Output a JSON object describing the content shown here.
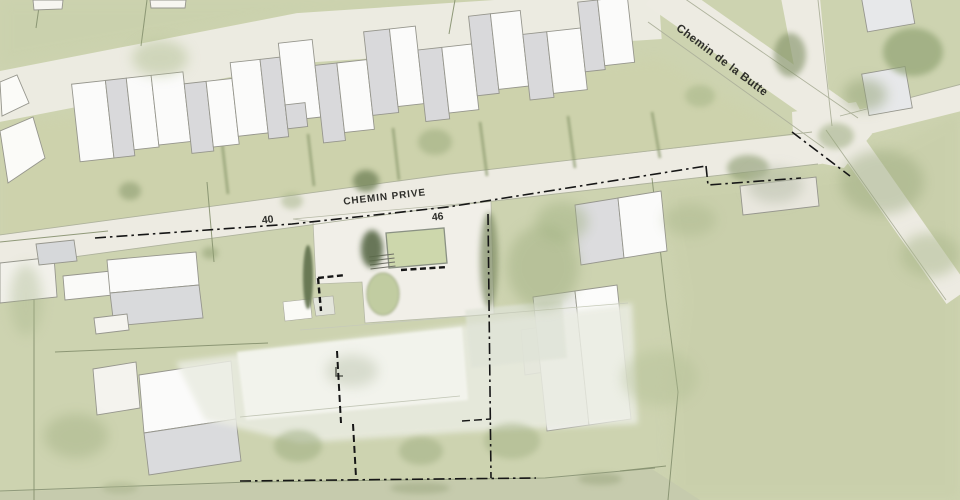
{
  "plan": {
    "type": "architectural-site-plan",
    "labels": {
      "main_road": "Chemin de la Butte",
      "private_road": "CHEMIN PRIVE",
      "house_number_left": "40",
      "house_number_right": "46"
    },
    "palette": {
      "lawn": "#cdd3b0",
      "road": "#edebe2",
      "building_white": "#fbfbfa",
      "building_gray": "#d9d9db",
      "pool_green": "#cdd7ac",
      "tree_green": "#8a996d",
      "boundary_black": "#161616"
    }
  }
}
